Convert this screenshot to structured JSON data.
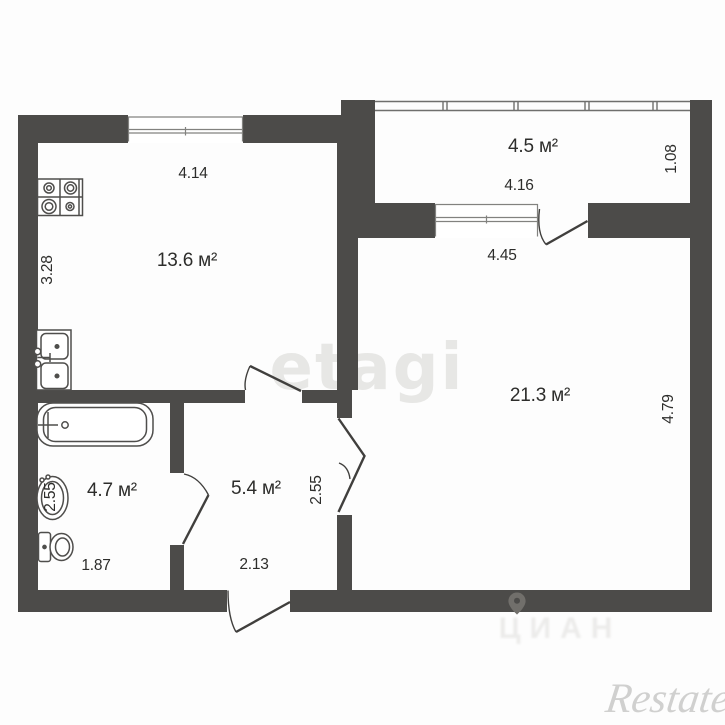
{
  "watermarks": {
    "center": "etagi",
    "bottom_center": "ЦИАН",
    "bottom_right": "Restate"
  },
  "rooms": {
    "kitchen": {
      "area": "13.6 м²",
      "width": "4.14",
      "depth": "3.28"
    },
    "living_room": {
      "area": "21.3 м²",
      "width": "4.45",
      "depth": "4.79"
    },
    "balcony": {
      "area": "4.5 м²",
      "width": "4.16",
      "depth": "1.08"
    },
    "bathroom": {
      "area": "4.7 м²",
      "width": "1.87",
      "depth": "2.55"
    },
    "hallway": {
      "area": "5.4 м²",
      "width": "2.13",
      "depth": "2.55"
    }
  },
  "fixtures": [
    "stove",
    "kitchen-sink",
    "bathtub",
    "washbasin",
    "toilet"
  ],
  "icons": {
    "location_pin": "map-pin-icon"
  },
  "colors": {
    "wall": "#4c4b49",
    "fixture_line": "#4f4e4c",
    "text": "#2d2d2b",
    "watermark": "#e7e7e5"
  }
}
